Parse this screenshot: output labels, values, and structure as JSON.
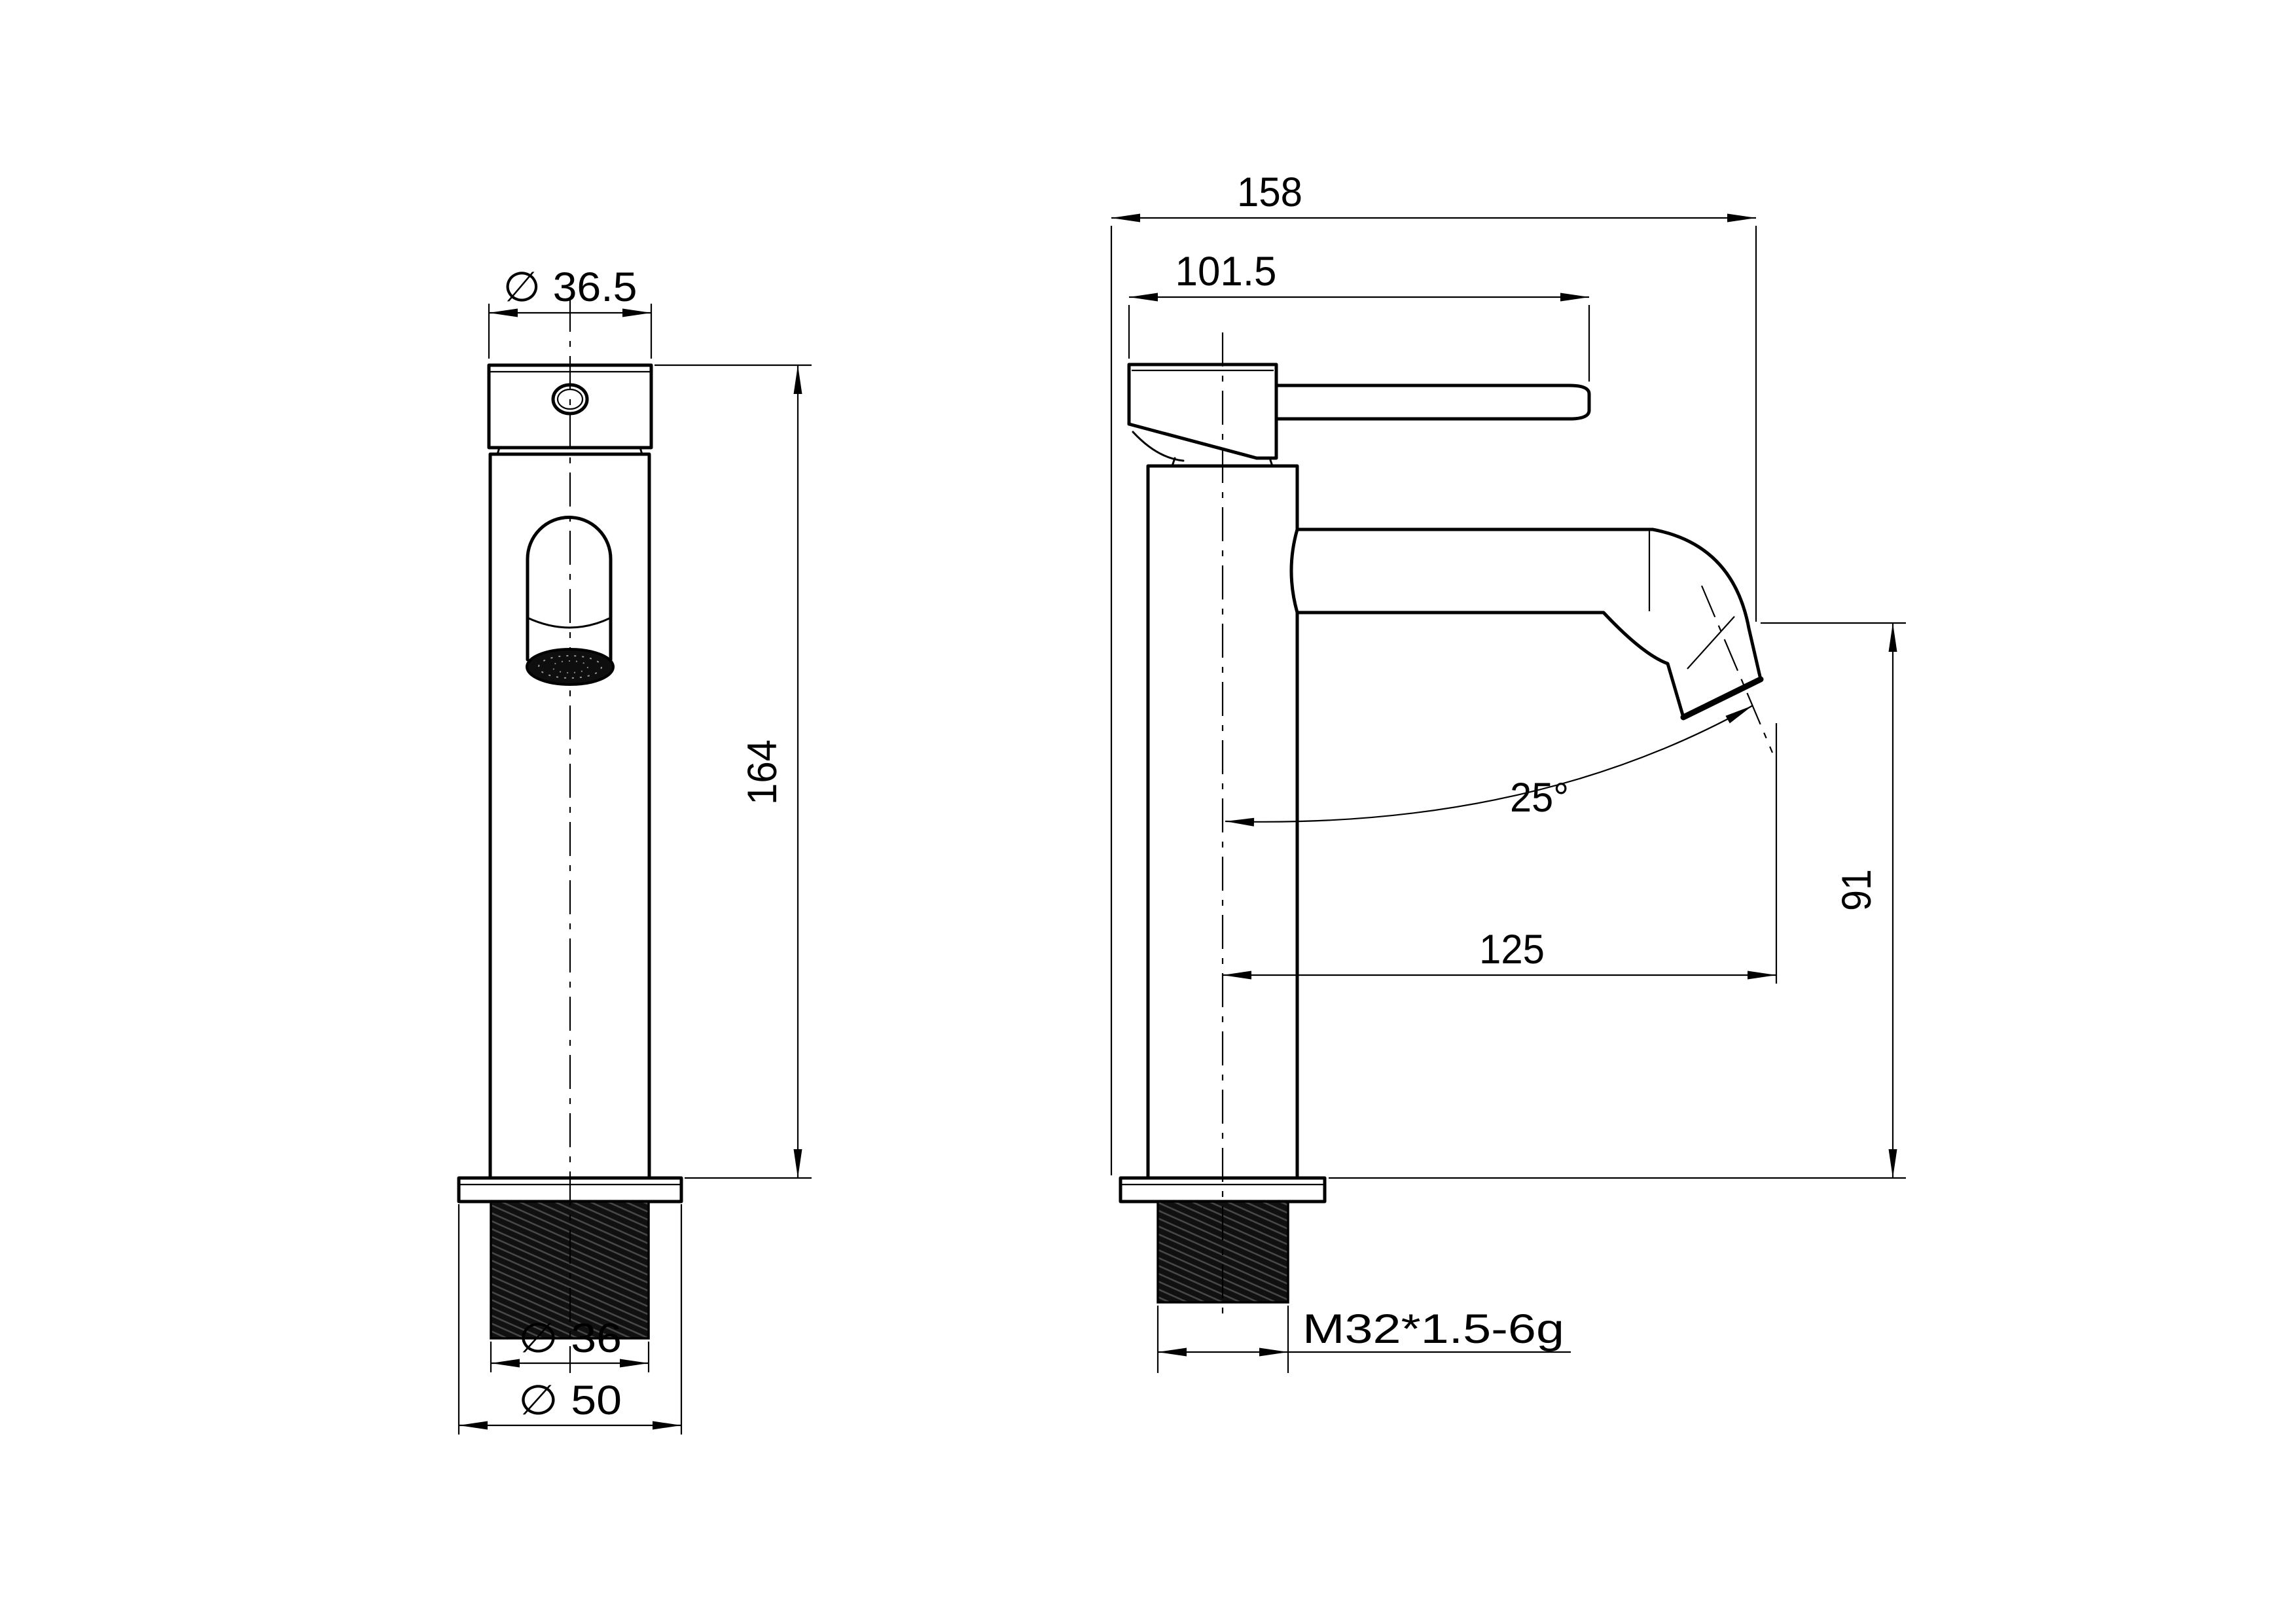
{
  "document": {
    "background": "#ffffff",
    "line_color": "#000000",
    "thread_fill": "#101010"
  },
  "front_view": {
    "dim_cap_diameter": "∅ 36.5",
    "dim_overall_height": "164",
    "dim_shank_diameter": "∅ 36",
    "dim_flange_diameter": "∅ 50"
  },
  "side_view": {
    "dim_overall_depth": "158",
    "dim_handle_reach": "101.5",
    "dim_spout_angle": "25°",
    "dim_spout_reach": "125",
    "dim_spout_height": "91",
    "dim_shank_thread": "M32*1.5-6g"
  }
}
